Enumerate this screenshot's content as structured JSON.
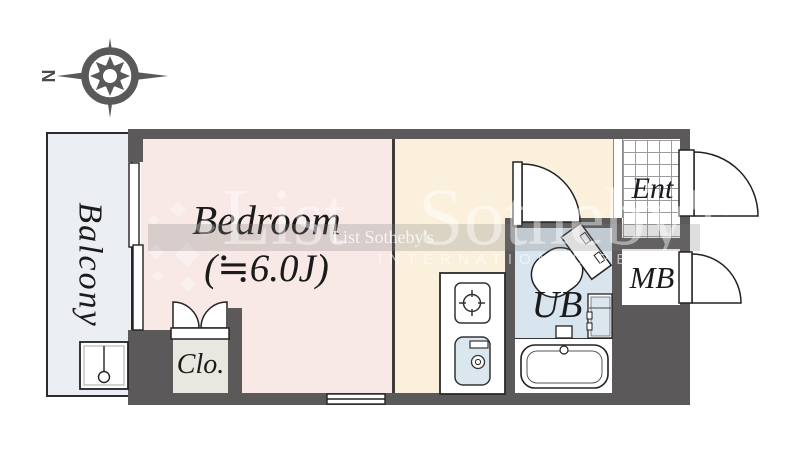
{
  "compass": {
    "north_label": "N"
  },
  "rooms": {
    "balcony": {
      "label": "Balcony"
    },
    "bedroom": {
      "label": "Bedroom",
      "size_label": "(≒6.0J)"
    },
    "closet": {
      "label": "Clo."
    },
    "unit_bath": {
      "label": "UB"
    },
    "entrance": {
      "label": "Ent"
    },
    "meter_box": {
      "label": "MB"
    }
  },
  "watermark": {
    "brand_first": "List",
    "brand_second": "Sotheby's",
    "band": "List Sotheby's",
    "subtitle": "INTERNATIONAL REALTY",
    "diamond_glyph": "◆"
  },
  "colors": {
    "wall": "#5b5959",
    "bedroom": "#f8e8e6",
    "kitchen": "#fbf0dc",
    "bath": "#d9e5ee",
    "balcony": "#ebeef3",
    "closet": "#e8e8e1",
    "fixture-blue": "#dbe7ef"
  }
}
